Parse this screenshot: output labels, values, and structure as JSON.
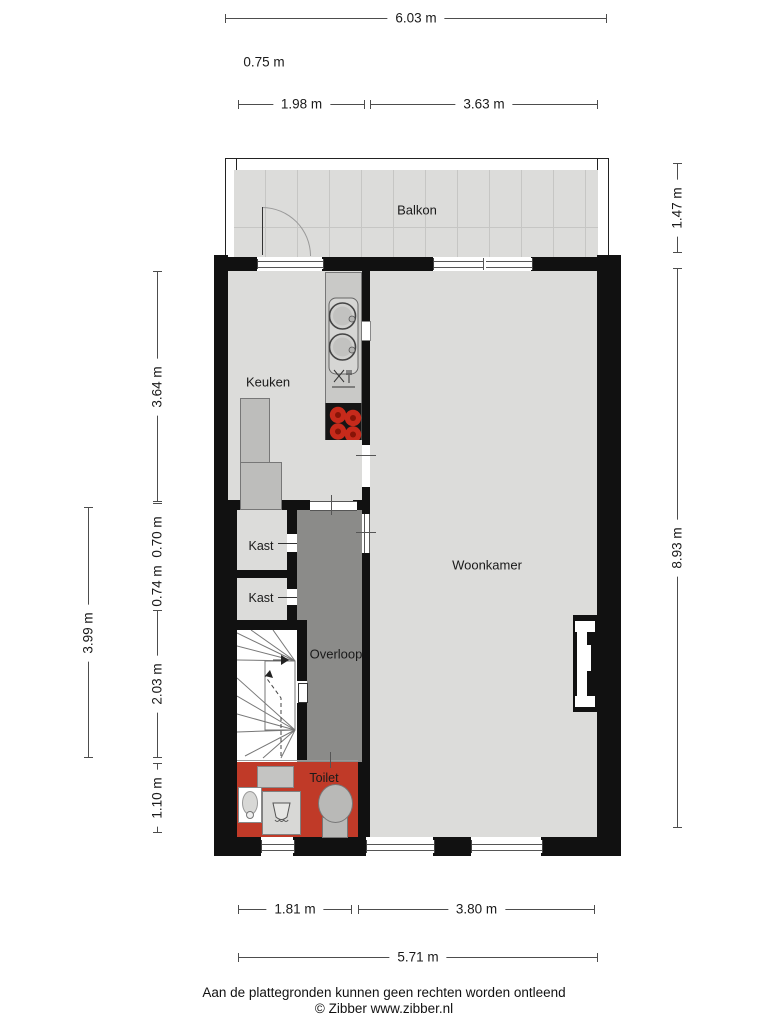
{
  "plan": {
    "rooms": {
      "balkon": {
        "label": "Balkon"
      },
      "keuken": {
        "label": "Keuken"
      },
      "woonkamer": {
        "label": "Woonkamer"
      },
      "kast_boven": {
        "label": "Kast"
      },
      "kast_onder": {
        "label": "Kast"
      },
      "overloop": {
        "label": "Overloop"
      },
      "toilet": {
        "label": "Toilet"
      }
    },
    "fixtures": [
      "kitchen-sink",
      "dishwasher",
      "cooktop",
      "kitchen-counter",
      "stairs",
      "toilet-bowl",
      "washbasin",
      "shower-tray",
      "chimney"
    ]
  },
  "dimensions": {
    "top_overall": "6.03 m",
    "balkon_offset": "0.75 m",
    "balkon_links": "1.98 m",
    "balkon_rechts": "3.63 m",
    "rechts_balkon": "1.47 m",
    "rechts_overall": "8.93 m",
    "links_keuken": "3.64 m",
    "links_kast_boven": "0.70 m",
    "links_kast_onder": "0.74 m",
    "links_overall": "3.99 m",
    "links_trap": "2.03 m",
    "links_toilet": "1.10 m",
    "onder_toilet": "1.81 m",
    "onder_woonkamer": "3.80 m",
    "onder_overall": "5.71 m"
  },
  "footer": {
    "disclaimer": "Aan de plattegronden kunnen geen rechten worden ontleend",
    "copyright": "© Zibber www.zibber.nl"
  },
  "colors": {
    "floor": "#dcdcda",
    "overloop_floor": "#8b8b89",
    "toilet_floor": "#c03a28",
    "wall": "#111111",
    "counter": "#c9c9c7",
    "burner_red": "#c62a1b"
  }
}
